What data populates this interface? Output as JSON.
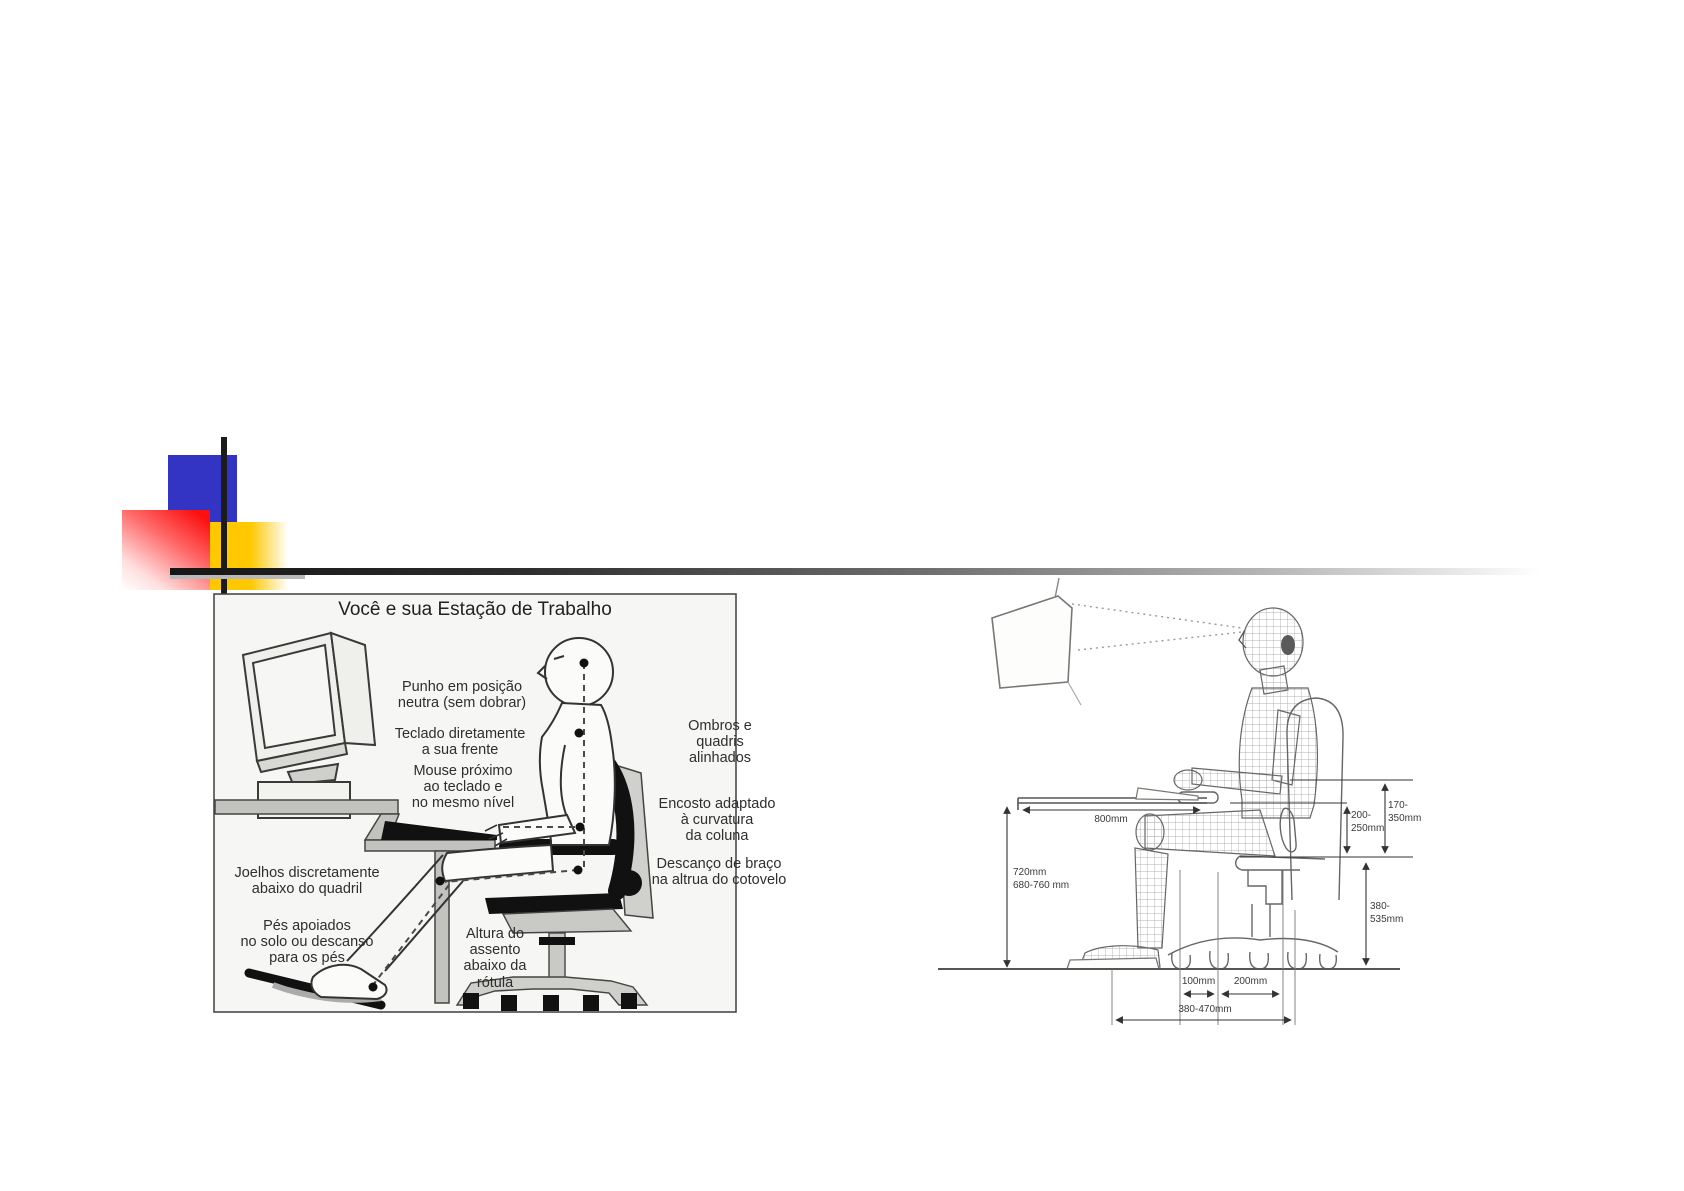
{
  "slide": {
    "background": "#ffffff",
    "decor_colors": {
      "blue": "#3333c4",
      "red": "#fb0f0f",
      "yellow": "#ffc800",
      "bar": "#1c1c1c"
    }
  },
  "left_diagram": {
    "title": "Você e sua Estação de Trabalho",
    "labels": [
      {
        "id": "wrist",
        "text": "Punho em posição\nneutra (sem dobrar)"
      },
      {
        "id": "keyboard",
        "text": "Teclado diretamente\na sua frente"
      },
      {
        "id": "mouse",
        "text": "Mouse próximo\nao teclado e\nno mesmo nível"
      },
      {
        "id": "shoulders",
        "text": "Ombros e\nquadris\nalinhados"
      },
      {
        "id": "backrest",
        "text": "Encosto adaptado\nà curvatura\nda coluna"
      },
      {
        "id": "armrest",
        "text": "Descanço de braço\nna altrua do cotovelo"
      },
      {
        "id": "knees",
        "text": "Joelhos discretamente\nabaixo do quadril"
      },
      {
        "id": "feet",
        "text": "Pés apoiados\nno solo ou descanso\npara os pés"
      },
      {
        "id": "seat",
        "text": "Altura do\nassento\nabaixo da\nrótula"
      }
    ]
  },
  "right_diagram": {
    "dimensions": {
      "desk_depth": "800mm",
      "desk_height": "720mm\n680-760 mm",
      "armrest_to_seat": "200-\n250mm",
      "elbow_range": "170-\n350mm",
      "seat_height": "380-535mm",
      "caster_offset": "100mm",
      "caster_spacing": "200mm",
      "base_span": "380-470mm"
    }
  }
}
